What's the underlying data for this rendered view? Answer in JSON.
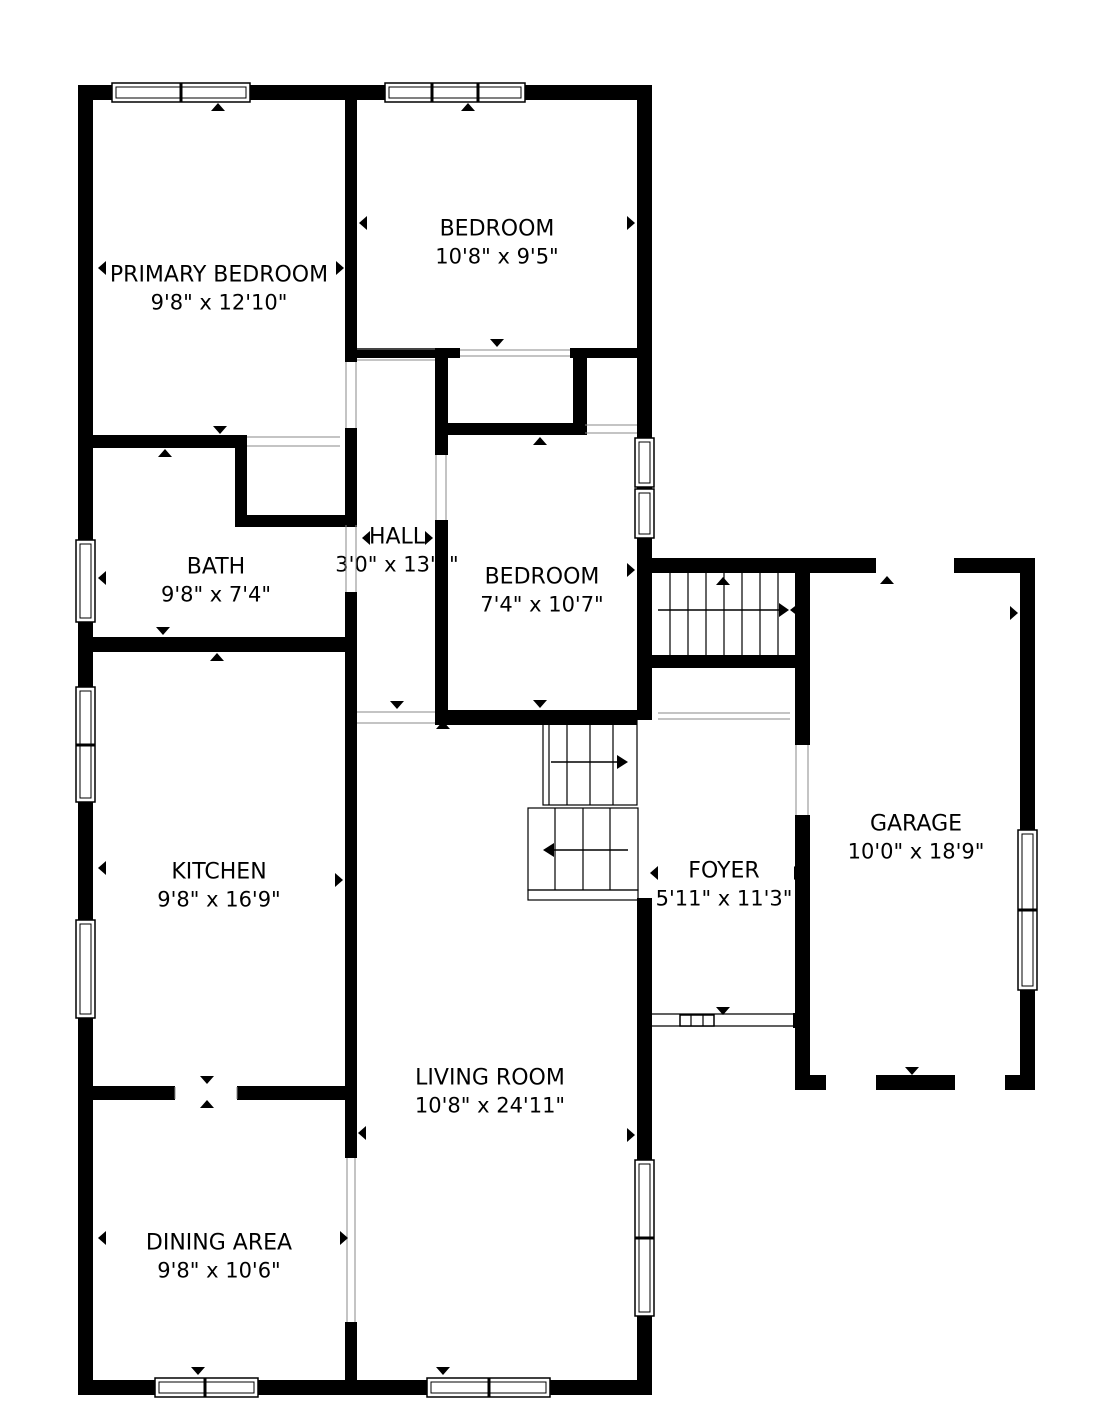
{
  "title": "Floor plan",
  "rooms": [
    {
      "name": "PRIMARY BEDROOM",
      "dims": "9'8\" x 12'10\""
    },
    {
      "name": "BEDROOM",
      "dims": "10'8\" x 9'5\""
    },
    {
      "name": "BATH",
      "dims": "9'8\" x 7'4\""
    },
    {
      "name": "HALL",
      "dims": "3'0\" x 13'4\""
    },
    {
      "name": "BEDROOM",
      "dims": "7'4\" x 10'7\""
    },
    {
      "name": "GARAGE",
      "dims": "10'0\" x 18'9\""
    },
    {
      "name": "KITCHEN",
      "dims": "9'8\" x 16'9\""
    },
    {
      "name": "FOYER",
      "dims": "5'11\" x 11'3\""
    },
    {
      "name": "LIVING ROOM",
      "dims": "10'8\" x 24'11\""
    },
    {
      "name": "DINING AREA",
      "dims": "9'8\" x 10'6\""
    }
  ],
  "colors": {
    "wall": "#000000",
    "background": "#ffffff",
    "text": "#000000",
    "opening_line": "#888888"
  }
}
